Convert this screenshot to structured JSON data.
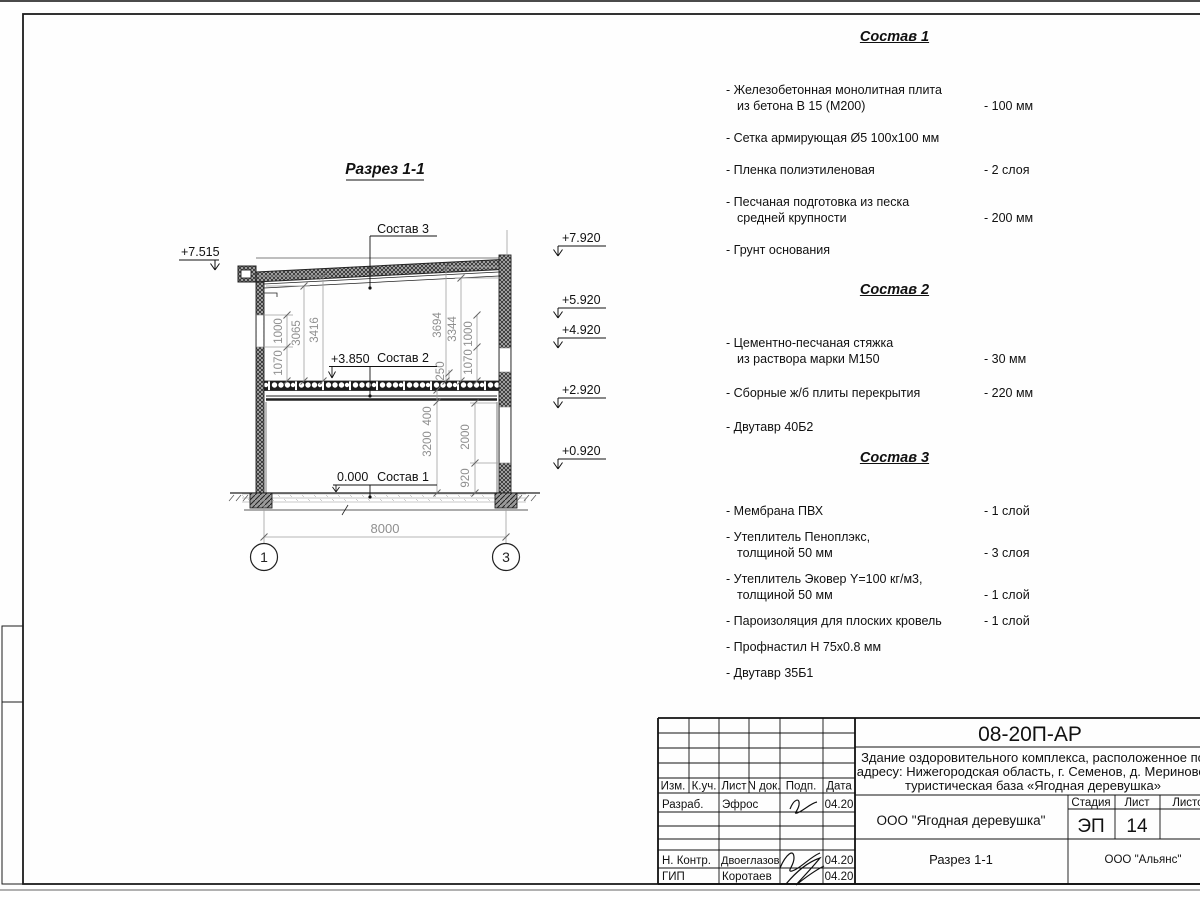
{
  "drawing": {
    "title": "Разрез 1-1",
    "leaders": {
      "s1": "Состав 1",
      "s2": "Состав 2",
      "s3": "Состав 3"
    },
    "levels": {
      "roof_left": "+7.515",
      "slab": "+3.850",
      "zero": "0.000"
    },
    "elev": {
      "e1": "+7.920",
      "e2": "+5.920",
      "e3": "+4.920",
      "e4": "+2.920",
      "e5": "+0.920"
    },
    "dims": {
      "l1000": "1000",
      "l1070": "1070",
      "d3065": "3065",
      "d3416": "3416",
      "d3694": "3694",
      "d3344": "3344",
      "d250": "250",
      "r1000": "1000",
      "r1070": "1070",
      "d400": "400",
      "d3200": "3200",
      "d2000": "2000",
      "d920": "920",
      "w8000": "8000"
    },
    "axes": {
      "a1": "1",
      "a3": "3"
    }
  },
  "specs": [
    {
      "title": "Состав 1",
      "items": [
        {
          "l1": "- Железобетонная  монолитная плита",
          "l2": "из бетона В 15 (М200)",
          "v": "- 100 мм"
        },
        {
          "l1": "- Сетка армирующая Ø5 100х100 мм"
        },
        {
          "l1": "- Пленка полиэтиленовая",
          "v": "-  2 слоя"
        },
        {
          "l1": "- Песчаная подготовка из песка",
          "l2": "средней крупности",
          "v": "- 200 мм"
        },
        {
          "l1": "- Грунт основания"
        }
      ]
    },
    {
      "title": "Состав 2",
      "items": [
        {
          "l1": "- Цементно-песчаная стяжка",
          "l2": "из раствора марки М150",
          "v": "- 30 мм"
        },
        {
          "l1": "- Сборные ж/б плиты перекрытия",
          "v": "- 220 мм"
        },
        {
          "l1": "- Двутавр 40Б2"
        }
      ]
    },
    {
      "title": "Состав 3",
      "items": [
        {
          "l1": "- Мембрана ПВХ",
          "v": "- 1 слой"
        },
        {
          "l1": "- Утеплитель Пеноплэкс,",
          "l2": "толщиной 50 мм",
          "v": "- 3 слоя"
        },
        {
          "l1": "- Утеплитель Эковер Y=100 кг/м3,",
          "l2": "толщиной 50 мм",
          "v": "- 1 слой"
        },
        {
          "l1": "- Пароизоляция для плоских кровель",
          "v": "- 1 слой"
        },
        {
          "l1": "- Профнастил Н 75х0.8 мм"
        },
        {
          "l1": "- Двутавр 35Б1"
        }
      ]
    }
  ],
  "titleblock": {
    "doc": "08-20П-АР",
    "desc1": "Здание оздоровительного комплекса, расположенное по",
    "desc2": "адресу: Нижегородская область, г. Семенов, д. Мериново,",
    "desc3": "туристическая база «Ягодная деревушка»",
    "org": "ООО \"Ягодная деревушка\"",
    "sheet_title": "Разрез 1-1",
    "contractor": "ООО \"Альянс\"",
    "stage_label": "Стадия",
    "sheet_label": "Лист",
    "sheets_label": "Листов",
    "stage": "ЭП",
    "sheet_num": "14",
    "cols": {
      "izm": "Изм.",
      "kuch": "К.уч.",
      "list": "Лист",
      "ndoc": "N док.",
      "podp": "Подп.",
      "data": "Дата"
    },
    "rows": {
      "razrab": "Разраб.",
      "nkontr": "Н. Контр.",
      "gip": "ГИП"
    },
    "names": {
      "razrab": "Эфрос",
      "nkontr": "Двоеглазов",
      "gip": "Коротаев"
    },
    "dates": {
      "razrab": "04.20",
      "nkontr": "04.20",
      "gip": "04.20"
    }
  }
}
